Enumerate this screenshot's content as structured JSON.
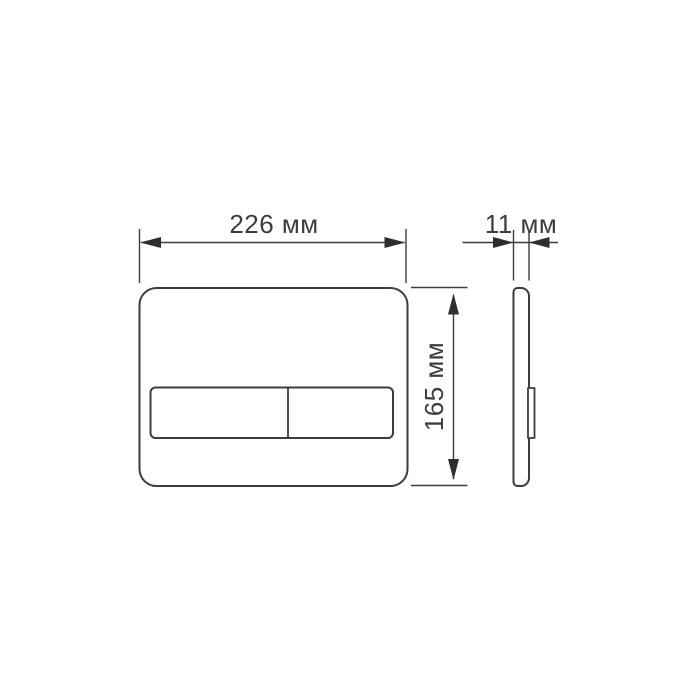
{
  "canvas": {
    "background": "#ffffff"
  },
  "drawing": {
    "dimensions": {
      "width": {
        "label": "226 мм",
        "value": "226",
        "unit": "мм"
      },
      "height": {
        "label": "165 мм",
        "value": "165",
        "unit": "мм"
      },
      "depth": {
        "label": "11 мм",
        "value": "11",
        "unit": "мм"
      }
    },
    "colors": {
      "line": "#3a3d40",
      "text": "#3b3e41",
      "arrow": "#2c2f31"
    }
  }
}
